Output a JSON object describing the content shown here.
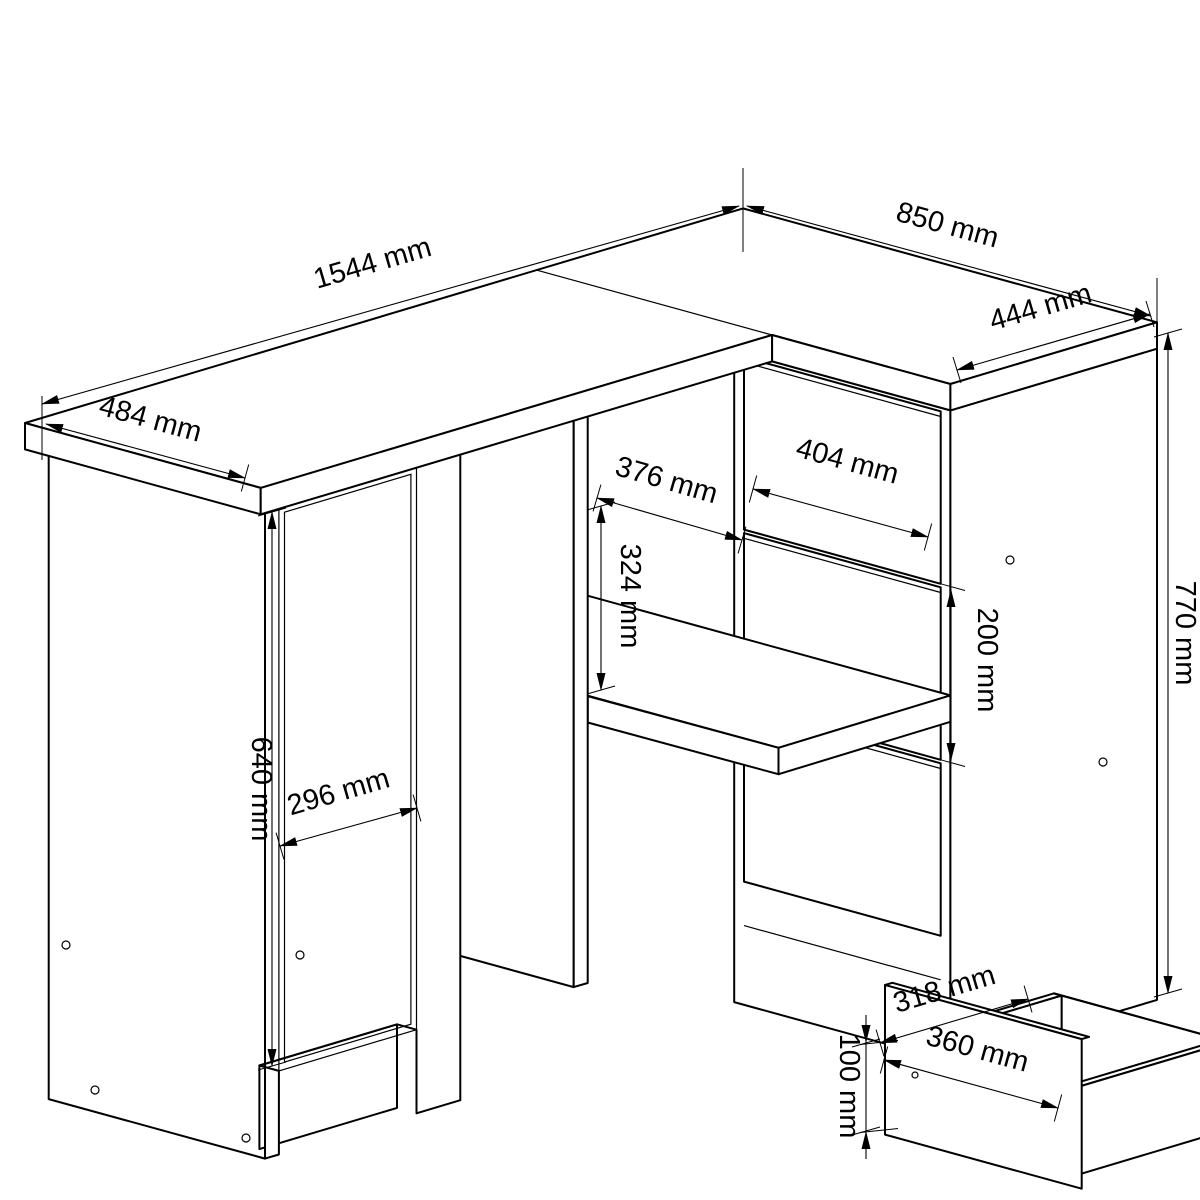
{
  "document": {
    "title": "Corner desk technical drawing",
    "type": "furniture dimensional diagram",
    "projection": "isometric line drawing",
    "unit": "mm",
    "colors": {
      "line": "#000000",
      "background": "#ffffff",
      "arrow": "#000000"
    }
  },
  "dims": {
    "desk_length": "1544 mm",
    "return_depth": "850 mm",
    "return_top_width": "444 mm",
    "left_end_depth": "484 mm",
    "door_height": "640 mm",
    "door_width": "296 mm",
    "niche_width": "376 mm",
    "niche_height": "324 mm",
    "drawer_front_width": "404 mm",
    "drawer_pitch": "200 mm",
    "side_height": "770 mm",
    "pulled_drawer_inner_depth": "318 mm",
    "pulled_drawer_width": "360 mm",
    "pulled_drawer_side_height": "100 mm"
  }
}
